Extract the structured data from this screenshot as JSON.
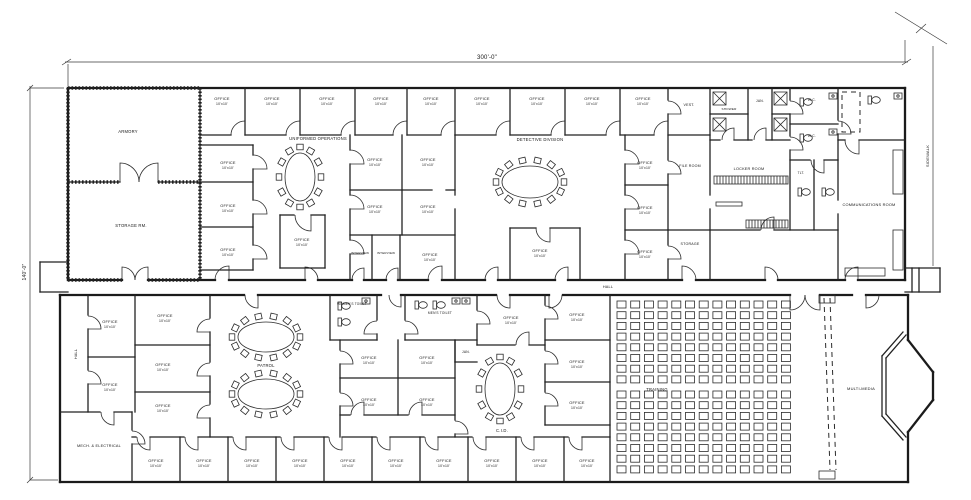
{
  "drawing_title": "POLICE FACILITY FLOOR PLAN",
  "dims": {
    "top": "300'-0\"",
    "left": "140'-0\"",
    "sidewalk": "SIDEWALK"
  },
  "rooms": {
    "armory": "ARMORY",
    "storage": "STORAGE RM.",
    "operations": "UNIFORMED OPERATIONS",
    "detective": "DETECTIVE DIVISION",
    "patrol": "PATROL",
    "training": "TRAINING",
    "media": "MULTI-MEDIA",
    "cid": "C.I.D.",
    "mech_electrical": "MECH. & ELECTRICAL",
    "communications": "COMMUNICATIONS ROOM",
    "locker_room": "LOCKER ROOM",
    "file_room": "FILE ROOM",
    "storage_small": "STORAGE",
    "vest": "VEST.",
    "jan": "JAN.",
    "shower": "SHOWER",
    "wc": "W.C.",
    "tlt": "TLT.",
    "womens_toilet": "WOMEN'S TOILET",
    "mens_toilet": "MEN'S TOILET",
    "interview": "INTERVIEW",
    "hall": "HALL",
    "office": "OFFICE",
    "office_size": "10'x10'"
  }
}
